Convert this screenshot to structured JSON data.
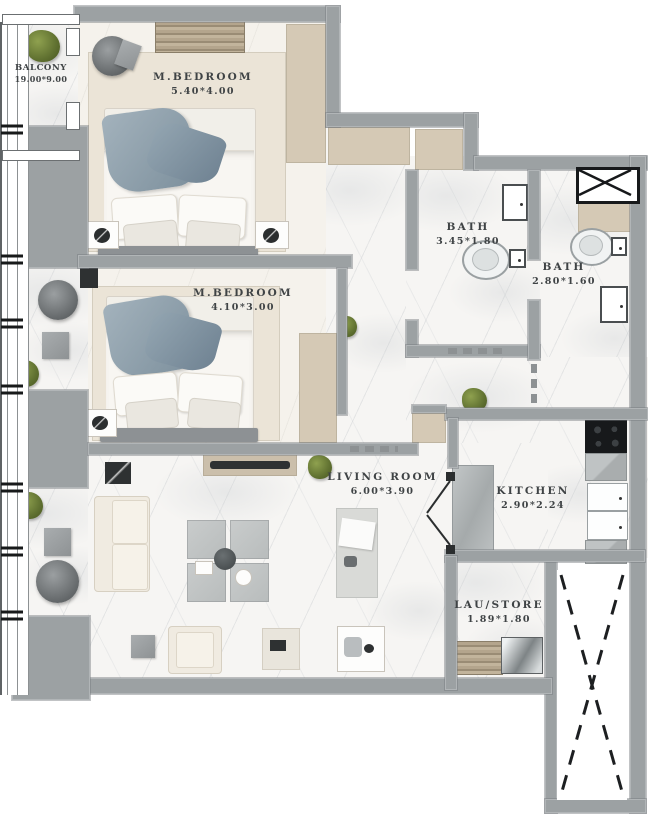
{
  "title": "Apartment floor plan",
  "rooms": {
    "balcony": {
      "name": "BALCONY",
      "dims": "19.00*9.00"
    },
    "bedroom1": {
      "name": "M.BEDROOM",
      "dims": "5.40*4.00"
    },
    "bedroom2": {
      "name": "M.BEDROOM",
      "dims": "4.10*3.00"
    },
    "bath1": {
      "name": "BATH",
      "dims": "3.45*1.80"
    },
    "bath2": {
      "name": "BATH",
      "dims": "2.80*1.60"
    },
    "living": {
      "name": "LIVING ROOM",
      "dims": "6.00*3.90"
    },
    "kitchen": {
      "name": "KITCHEN",
      "dims": "2.90*2.24"
    },
    "laustore": {
      "name": "LAU/STORE",
      "dims": "1.89*1.80"
    }
  },
  "colors": {
    "wall": "#9ca1a3",
    "closet_tan": "#d5c9b5",
    "rug_beige": "#ebe4d7",
    "floor_marble": "#f6f5f3",
    "blanket_blue": "#8ba0ad",
    "label_text": "#3f4345",
    "plant_green": "#5f7030"
  }
}
